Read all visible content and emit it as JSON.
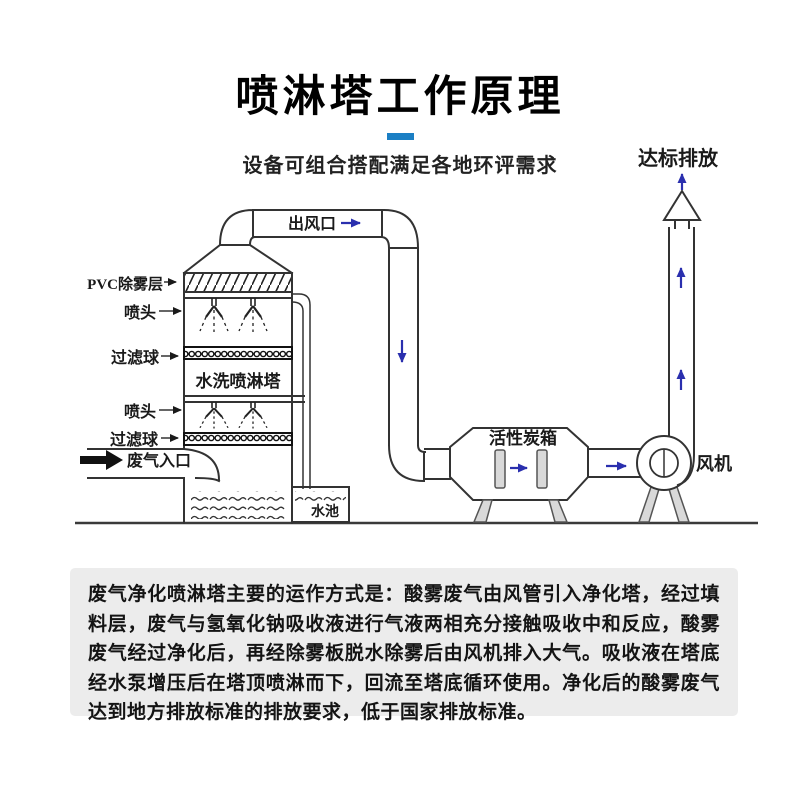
{
  "header": {
    "title": "喷淋塔工作原理",
    "subtitle": "设备可组合搭配满足各地环评需求",
    "accent_color": "#1b7fc4"
  },
  "diagram": {
    "emission_label": "达标排放",
    "outlet_label": "出风口",
    "pvc_layer_label": "PVC除雾层",
    "nozzle_label_1": "喷头",
    "filter_ball_label_1": "过滤球",
    "tower_label": "水洗喷淋塔",
    "nozzle_label_2": "喷头",
    "filter_ball_label_2": "过滤球",
    "gas_inlet_label": "废气入口",
    "pool_label": "水池",
    "carbon_box_label": "活性炭箱",
    "fan_label": "风机",
    "flow_arrow_color": "#2a2fae",
    "line_color": "#333333",
    "leg_fill_color": "#d9d9d9"
  },
  "description": {
    "text": "废气净化喷淋塔主要的运作方式是：酸雾废气由风管引入净化塔，经过填料层，废气与氢氧化钠吸收液进行气液两相充分接触吸收中和反应，酸雾废气经过净化后，再经除雾板脱水除雾后由风机排入大气。吸收液在塔底经水泵增压后在塔顶喷淋而下，回流至塔底循环使用。净化后的酸雾废气达到地方排放标准的排放要求，低于国家排放标准。"
  }
}
